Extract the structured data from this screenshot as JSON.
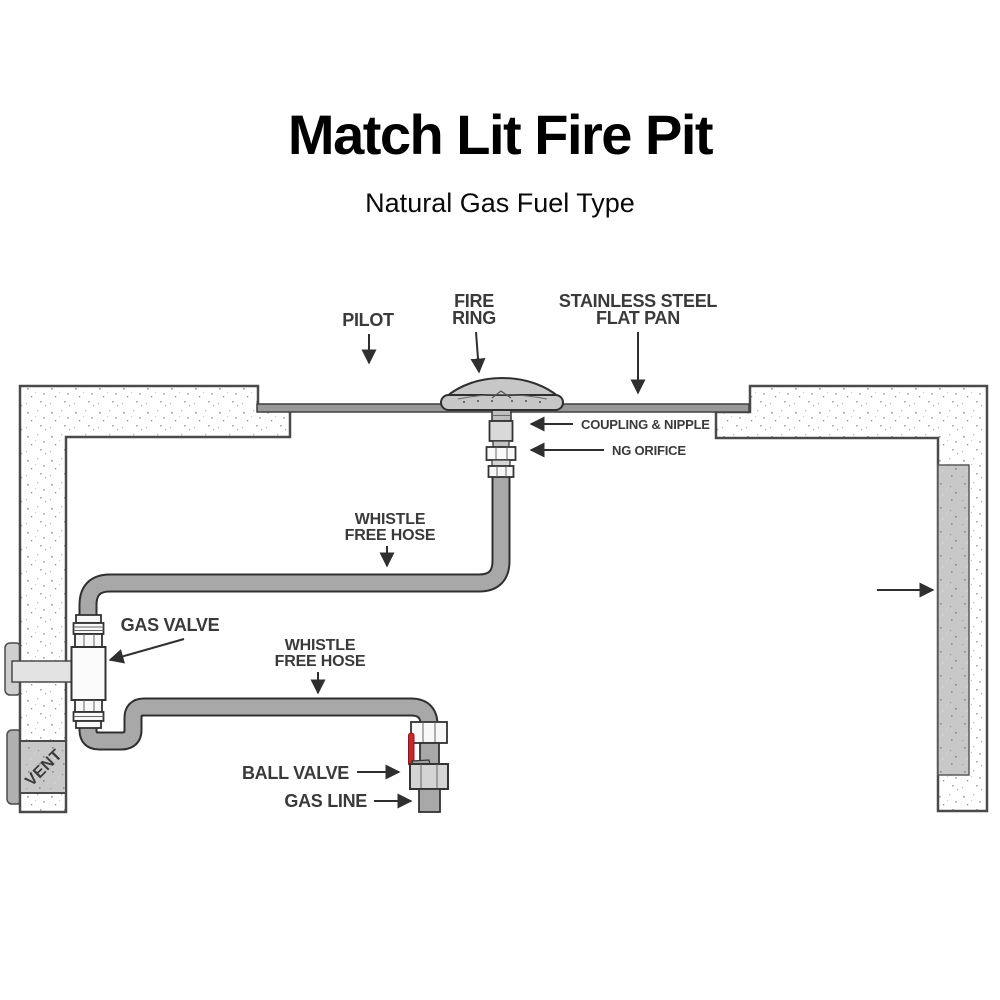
{
  "header": {
    "title": "Match Lit Fire Pit",
    "subtitle": "Natural Gas Fuel Type"
  },
  "labels": {
    "pilot": "PILOT",
    "fire_ring_line1": "FIRE",
    "fire_ring_line2": "RING",
    "flat_pan_line1": "STAINLESS STEEL",
    "flat_pan_line2": "FLAT PAN",
    "coupling_nipple": "COUPLING & NIPPLE",
    "ng_orifice": "NG ORIFICE",
    "whistle_hose_upper_line1": "WHISTLE",
    "whistle_hose_upper_line2": "FREE HOSE",
    "gas_valve": "GAS VALVE",
    "whistle_hose_lower_line1": "WHISTLE",
    "whistle_hose_lower_line2": "FREE HOSE",
    "ball_valve": "BALL VALVE",
    "gas_line": "GAS LINE",
    "vent": "VENT"
  },
  "colors": {
    "label_text": "#3a3a3a",
    "title_text": "#000000",
    "hose_fill": "#a8a8a8",
    "hose_outline": "#2f2f2f",
    "pan_fill": "#999999",
    "ring_fill": "#c7c7c7",
    "fitting_fill": "#f8f8f8",
    "coupling_fill": "#d9d9d9",
    "valve_body_fill": "#fbfbfb",
    "ball_valve_fill": "#d4d4d4",
    "handle_red": "#c9272b",
    "wall_outline": "#4a4a4a",
    "vent_panel_fill": "#c8c8c8",
    "key_shaft_fill": "#e3e3e3",
    "arrow": "#2f2f2f"
  }
}
